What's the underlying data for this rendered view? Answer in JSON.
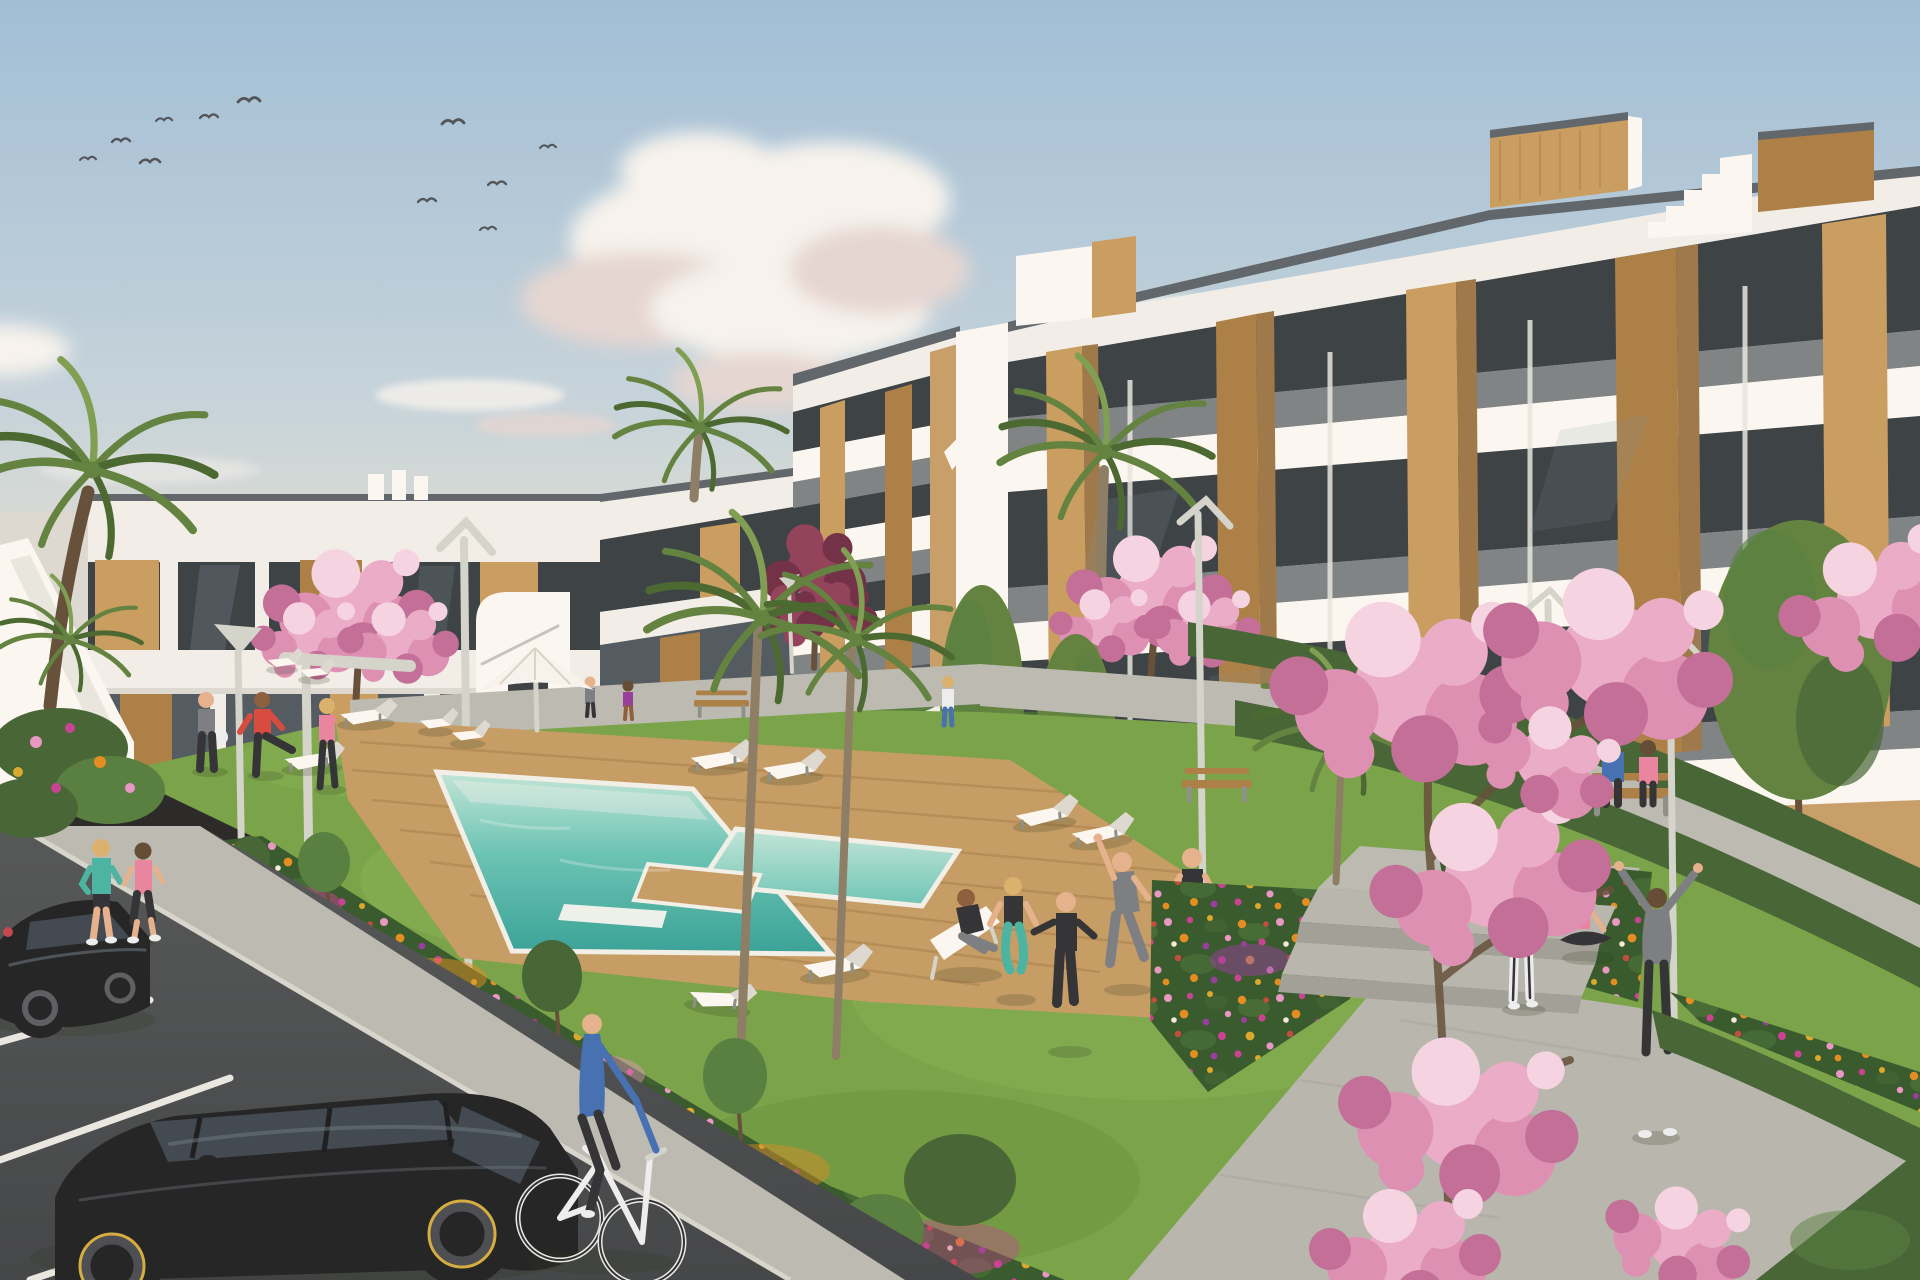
{
  "meta": {
    "description": "3D architectural rendering of a modern white apartment complex with communal turquoise pool, wooden sun deck, flower gardens, lawns, parking and residents exercising",
    "width_px": 1920,
    "height_px": 1280
  },
  "palette": {
    "sky_top": "#9dbdd8",
    "sky_mid": "#c3d3dd",
    "sky_horizon": "#e9e1d2",
    "cloud_white": "#f7f4f0",
    "cloud_shadow": "#e4d6d3",
    "bird": "#4a4f55",
    "building_white": "#f2f0ea",
    "building_bright": "#fbf9f4",
    "building_shade": "#dcdad2",
    "building_deep": "#c2c0b7",
    "coping": "#5a6168",
    "glass_dark": "#343b41",
    "glass_mid": "#4b565e",
    "glass_reflect": "#8295a1",
    "balustrade": "#5f666c",
    "wood_light": "#c89a5c",
    "wood_mid": "#a97c42",
    "wood_dark": "#7e5a2e",
    "tan_wall": "#c69c66",
    "tan_dark": "#9a7444",
    "grass": "#74a144",
    "grass_light": "#8cb858",
    "grass_dark": "#527f2e",
    "hedge": "#3f6030",
    "hedge_light": "#527c3c",
    "bed_green": "#2f5526",
    "flower_orange": "#e2891c",
    "flower_gold": "#d9a828",
    "flower_magenta": "#c73c92",
    "flower_pink": "#e795c4",
    "flower_purple": "#93379b",
    "flower_red": "#c04638",
    "flower_white": "#f2ead8",
    "blossom_pink": "#eaaac9",
    "blossom_mid": "#dd8db4",
    "blossom_deep": "#c06a96",
    "blossom_pale": "#f5d3e3",
    "purple_leaf": "#8e3b56",
    "purple_leaf_dark": "#6d2a44",
    "palm_green": "#5d7f3a",
    "palm_dark": "#42642b",
    "palm_light": "#7b9c4e",
    "trunk": "#8a7a63",
    "trunk_dark": "#5f4a35",
    "deck_wood": "#c49a62",
    "deck_line": "#a97f48",
    "pool_shallow": "#c2e7da",
    "pool_mid": "#63c2b4",
    "pool_deep": "#2e9e94",
    "path": "#b9b9b1",
    "path_shadow": "#a3a39b",
    "walkway": "#b5b5ad",
    "step_face": "#9e9e96",
    "road": "#4e5254",
    "road_dark": "#3d4043",
    "stall_line": "#e8e8e2",
    "curb": "#d6d6ce",
    "car_black": "#1c1d20",
    "car_glass": "#3a434c",
    "car_highlight": "#6f7e8a",
    "rim_yellow": "#d4ab3c",
    "skin": "#e5b08c",
    "skin_dark": "#8a5a38",
    "outfit_teal": "#45b3a2",
    "outfit_pink": "#e8819f",
    "outfit_red": "#d6453a",
    "outfit_blue": "#3e6cb0",
    "outfit_gray": "#787b80",
    "outfit_black": "#2b2c30",
    "outfit_white": "#eceff1",
    "lamp_metal": "#d3d4cc",
    "lamp_dark": "#8b8d88",
    "hair_blonde": "#d9b06a",
    "hair_brown": "#5e4630"
  },
  "scene": {
    "sky": {
      "birds": 11,
      "clouds": [
        "large cumulus left of center",
        "wispy streaks above rooflines",
        "small puff upper right of center"
      ]
    },
    "buildings": [
      {
        "id": "left-low-rise",
        "floors": 2,
        "style": "white modern block, deep fascias, smoked glass, vertical timber cladding",
        "features": [
          "external side staircase",
          "rooftop parapet fins",
          "white curved stair tower"
        ]
      },
      {
        "id": "main-block",
        "floors": 4,
        "style": "white terraced block with stacked balcony slabs, smoked-glass balustrades, timber piers, tan recesses",
        "features": [
          "rooftop timber stair bulkheads",
          "stepped roofline",
          "recessed ground floor behind hedge"
        ]
      }
    ],
    "amenities": {
      "pool": {
        "water": "turquoise",
        "attached_jacuzzi": true,
        "inner_ledges": 2,
        "deck": "tropical hardwood planks"
      },
      "parasol": 1,
      "sun_loungers": 9,
      "deck_chairs": 3,
      "benches": 3
    },
    "vegetation": {
      "palms": 7,
      "cherry_blossom_trees": 5,
      "purple_leaf_trees": 2,
      "green_poplars": 3,
      "flower_beds": "drifts of orange, gold, magenta, pink and purple annuals",
      "hedges": "clipped dark-green bands along paths and facades",
      "foreground": "pink blossom branches overhanging lower right"
    },
    "people": [
      {
        "label": "jogger",
        "outfit": "teal long-sleeve, black shorts"
      },
      {
        "label": "jogger",
        "outfit": "pink tank, dark capri leggings"
      },
      {
        "label": "cyclist",
        "outfit": "blue sweater, dark jeans, white bicycle"
      },
      {
        "label": "man holding ball",
        "outfit": "gray tee, dark trousers"
      },
      {
        "label": "man stretching leg on lounger",
        "outfit": "red tee, dark leggings"
      },
      {
        "label": "woman walking poolside",
        "outfit": "pink top, dark leggings"
      },
      {
        "label": "man seated in deck chair",
        "outfit": "dark top, gray trousers"
      },
      {
        "label": "woman squatting",
        "outfit": "black top, teal leggings"
      },
      {
        "label": "man in tracksuit pointing",
        "outfit": "black tracksuit"
      },
      {
        "label": "man side-stretching",
        "outfit": "gray tee and joggers"
      },
      {
        "label": "man hands on hips",
        "outfit": "dark tee, shorts, yellow shoes"
      },
      {
        "label": "person seated cross-legged",
        "outfit": "dark tracksuit"
      },
      {
        "label": "standing woman",
        "outfit": "black tank, white striped leggings"
      },
      {
        "label": "seated woman",
        "outfit": "coral-pink top, black leggings"
      },
      {
        "label": "woman stretching arms up",
        "outfit": "gray hoodie, dark leggings"
      },
      {
        "label": "couple on bench",
        "outfit": "blue top and dark-pink top"
      },
      {
        "label": "two small walkers on far path",
        "outfit": "mixed"
      }
    ],
    "vehicles": [
      {
        "type": "hatchback",
        "color": "black",
        "rim_accent": "yellow"
      },
      {
        "type": "sedan",
        "color": "black"
      },
      {
        "type": "bicycle",
        "color": "white"
      }
    ],
    "street_furniture": {
      "lampposts": 7,
      "concrete_steps": 3,
      "paths": "pale concrete",
      "parking": "asphalt bays with white lines"
    }
  }
}
